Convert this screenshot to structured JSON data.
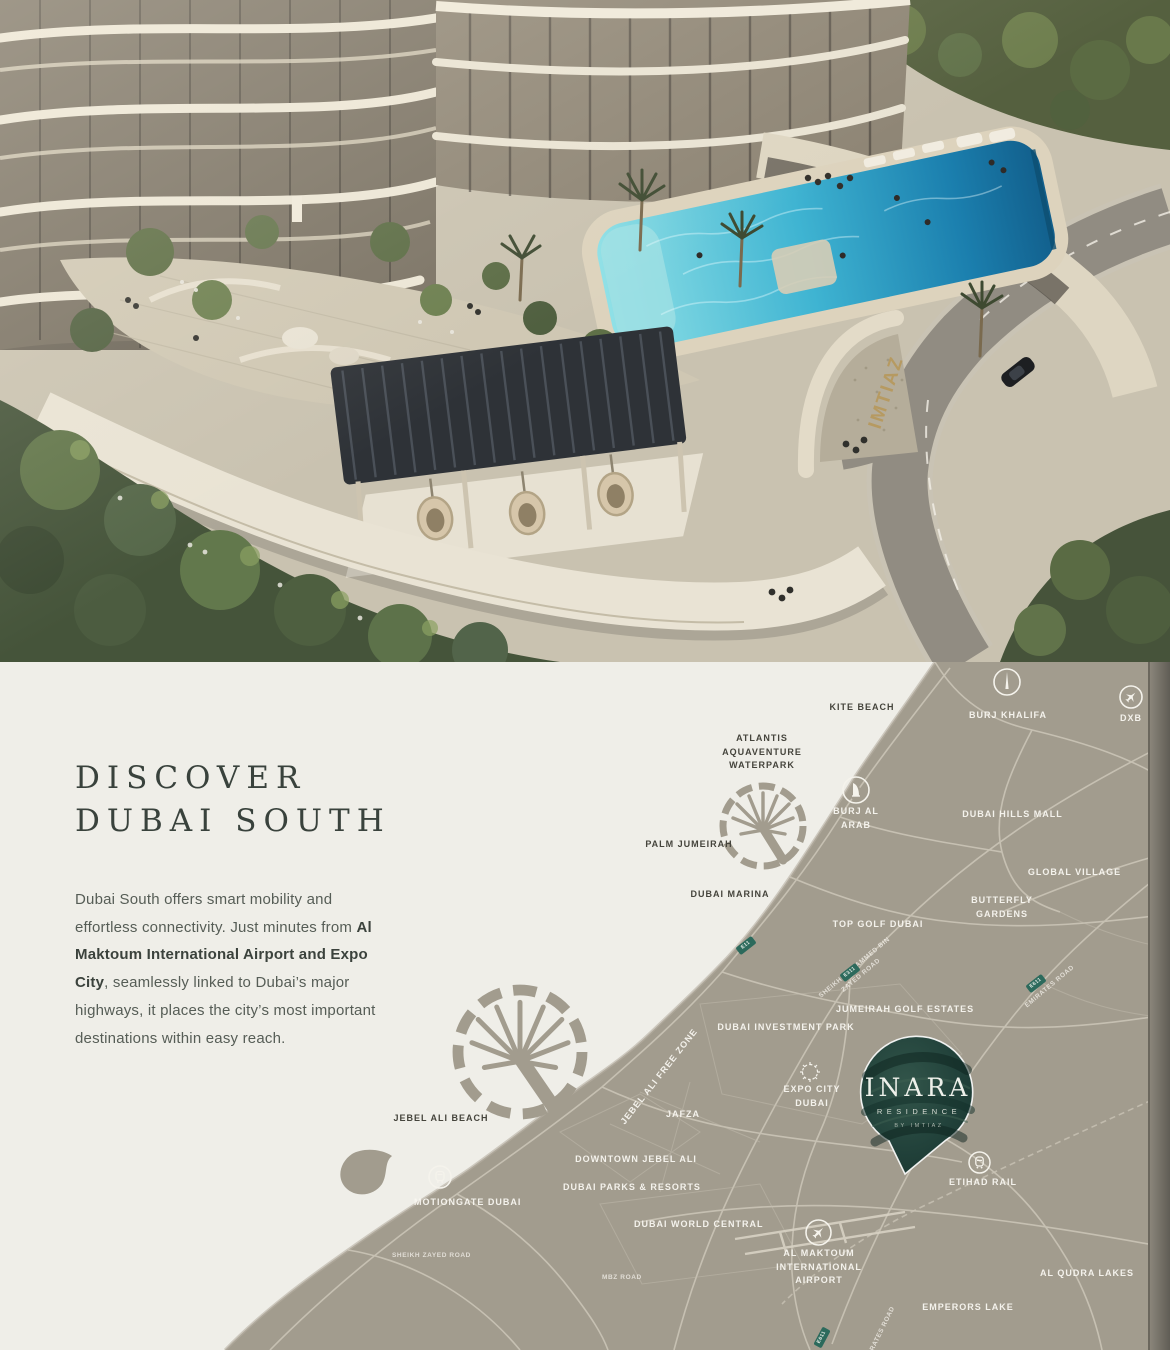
{
  "photo": {
    "gate_sign": "IMTIAZ"
  },
  "intro": {
    "heading_line1": "DISCOVER",
    "heading_line2": "DUBAI SOUTH",
    "para_1": "Dubai South offers smart mobility and effortless connectivity. Just minutes from ",
    "para_bold": "Al Maktoum International Airport and Expo City",
    "para_2": ", seamlessly linked to Dubai’s major highways, it places the city’s most important destinations within easy reach."
  },
  "map": {
    "colors": {
      "sea": "#efeee8",
      "land": "#a29c8e",
      "road": "#cdc7b9",
      "badge_green": "#2c6a5c",
      "pin_green": "#1e3d34",
      "label_light": "#f9f7f1",
      "label_dark": "#45443c"
    },
    "pin": {
      "title": "INARA",
      "subtitle": "RESIDENCE",
      "byline": "BY IMTIAZ"
    },
    "labels": {
      "kite_beach": "KITE BEACH",
      "burj_khalifa": "BURJ KHALIFA",
      "dxb": "DXB",
      "atlantis": "ATLANTIS AQUAVENTURE WATERPARK",
      "burj_al_arab": "BURJ AL ARAB",
      "dubai_hills_mall": "DUBAI HILLS MALL",
      "palm_jumeirah": "PALM JUMEIRAH",
      "dubai_marina": "DUBAI MARINA",
      "global_village": "GLOBAL VILLAGE",
      "butterfly_gardens": "BUTTERFLY GARDENS",
      "top_golf": "TOP GOLF DUBAI",
      "jumeirah_golf_estates": "JUMEIRAH GOLF ESTATES",
      "dubai_investment_park": "DUBAI INVESTMENT PARK",
      "expo_city": "EXPO CITY DUBAI",
      "jafza": "JAFZA",
      "jebel_ali_free_zone": "JEBEL ALI FREE ZONE",
      "jebel_ali_beach": "JEBEL ALI BEACH",
      "downtown_jebel_ali": "DOWNTOWN JEBEL ALI",
      "dubai_parks_resorts": "DUBAI PARKS & RESORTS",
      "motiongate": "MOTIONGATE DUBAI",
      "dubai_world_central": "DUBAI WORLD CENTRAL",
      "al_maktoum_airport": "AL MAKTOUM INTERNATIONAL AIRPORT",
      "etihad_rail": "ETIHAD RAIL",
      "al_qudra_lakes": "AL QUDRA LAKES",
      "emperors_lake": "EMPERORS LAKE"
    },
    "roads": {
      "sheikh_zayed_road": "SHEIKH ZAYED ROAD",
      "mbz_road": "MBZ ROAD",
      "sheikh_mohammed_bin_zayed_road": "SHEIKH MOHAMMED BIN ZAYED ROAD",
      "emirates_road": "EMIRATES ROAD",
      "emirates_road_south": "EMIRATES ROAD"
    },
    "badges": {
      "e11": "E11",
      "e311": "E311",
      "e611": "E611",
      "e611_south": "E611"
    }
  }
}
